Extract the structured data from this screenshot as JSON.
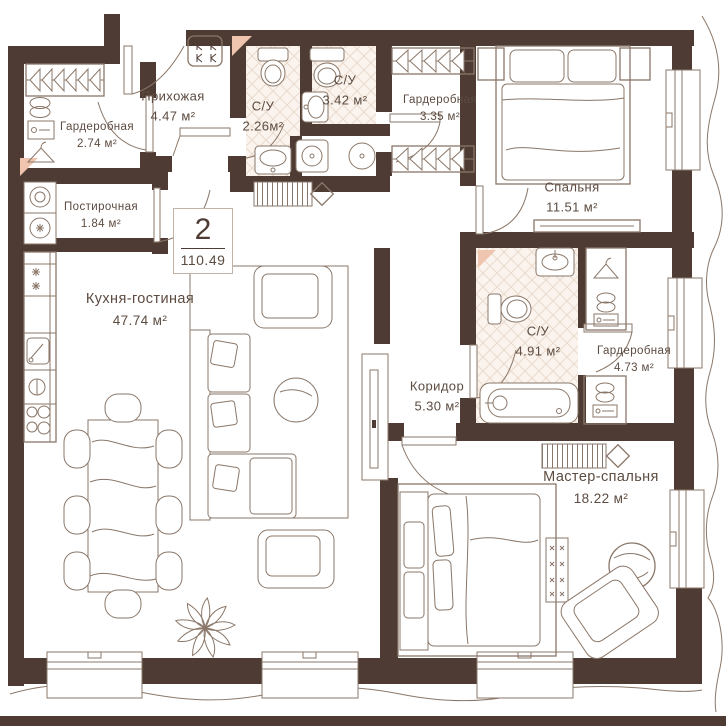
{
  "plan": {
    "title": "apartment floor plan",
    "badge": {
      "rooms": "2",
      "total_area": "110.49"
    },
    "rooms": [
      {
        "id": "hallway",
        "name": "Прихожая",
        "area": "4.47 м²"
      },
      {
        "id": "wardrobe_1",
        "name": "Гардеробная",
        "area": "2.74 м²"
      },
      {
        "id": "laundry",
        "name": "Постирочная",
        "area": "1.84 м²"
      },
      {
        "id": "bath_1",
        "name": "С/У",
        "area": "2.26м²"
      },
      {
        "id": "bath_2",
        "name": "С/У",
        "area": "3.42 м²"
      },
      {
        "id": "wardrobe_2",
        "name": "Гардеробная",
        "area": "3.35 м²"
      },
      {
        "id": "bedroom",
        "name": "Спальня",
        "area": "11.51 м²"
      },
      {
        "id": "kitchen_living",
        "name": "Кухня-гостиная",
        "area": "47.74 м²"
      },
      {
        "id": "corridor",
        "name": "Коридор",
        "area": "5.30 м²"
      },
      {
        "id": "bath_3",
        "name": "С/У",
        "area": "4.91 м²"
      },
      {
        "id": "wardrobe_3",
        "name": "Гардеробная",
        "area": "4.73 м²"
      },
      {
        "id": "master_bedroom",
        "name": "Мастер-спальня",
        "area": "18.22 м²"
      }
    ],
    "colors": {
      "wall": "#4e3c34",
      "line": "#8a7769",
      "tile_bg": "#fbf4ee",
      "tile_line": "#eadbcd",
      "accent": "#f0c5b0",
      "text": "#5c4b40"
    }
  }
}
